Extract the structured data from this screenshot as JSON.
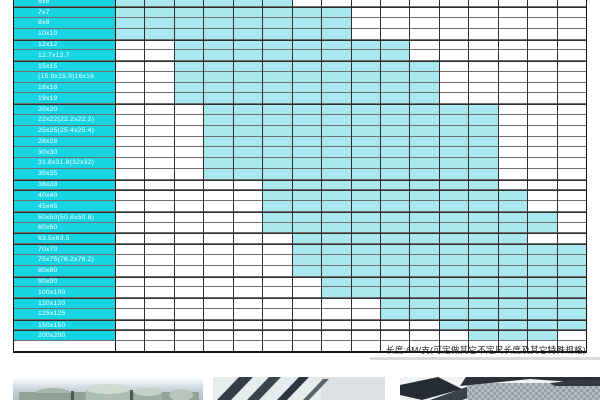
{
  "table": {
    "columns_visible": 16,
    "rows": [
      {
        "label": "6x6",
        "from": 1,
        "to": 6
      },
      {
        "label": "7x7",
        "from": 1,
        "to": 8
      },
      {
        "label": "8x8",
        "from": 1,
        "to": 8
      },
      {
        "label": "10x10",
        "from": 1,
        "to": 8
      },
      {
        "label": "12x12",
        "from": 3,
        "to": 10
      },
      {
        "label": "12.7x12.7",
        "from": 3,
        "to": 10
      },
      {
        "label": "15x15",
        "from": 3,
        "to": 11
      },
      {
        "label": "(15.9x15.9)16x16",
        "from": 3,
        "to": 11
      },
      {
        "label": "18x18",
        "from": 3,
        "to": 11
      },
      {
        "label": "19x19",
        "from": 3,
        "to": 11
      },
      {
        "label": "20x20",
        "from": 4,
        "to": 13
      },
      {
        "label": "22x22(22.2x22.2)",
        "from": 4,
        "to": 13
      },
      {
        "label": "25x25(25.4x25.4)",
        "from": 4,
        "to": 13
      },
      {
        "label": "28x28",
        "from": 4,
        "to": 13
      },
      {
        "label": "30x30",
        "from": 4,
        "to": 13
      },
      {
        "label": "31.8x31.8(32x32)",
        "from": 4,
        "to": 13
      },
      {
        "label": "35x35",
        "from": 4,
        "to": 13
      },
      {
        "label": "38x38",
        "from": 6,
        "to": 13
      },
      {
        "label": "40x40",
        "from": 6,
        "to": 14
      },
      {
        "label": "45x45",
        "from": 6,
        "to": 14
      },
      {
        "label": "50x50(50.8x50.8)",
        "from": 6,
        "to": 15
      },
      {
        "label": "60x60",
        "from": 6,
        "to": 15
      },
      {
        "label": "63.5x63.5",
        "from": 7,
        "to": 14
      },
      {
        "label": "70x70",
        "from": 7,
        "to": 16
      },
      {
        "label": "75x75(76.2x76.2)",
        "from": 7,
        "to": 16
      },
      {
        "label": "80x80",
        "from": 7,
        "to": 16
      },
      {
        "label": "90x90",
        "from": 8,
        "to": 16
      },
      {
        "label": "100x100",
        "from": 8,
        "to": 16
      },
      {
        "label": "120x120",
        "from": 10,
        "to": 16
      },
      {
        "label": "125x125",
        "from": 10,
        "to": 16
      },
      {
        "label": "150x150",
        "from": 12,
        "to": 16
      },
      {
        "label": "200x200",
        "from": 13,
        "to": 15
      }
    ],
    "colors": {
      "label_bg": "#15d4e4",
      "available_cell": "#a9e8ef",
      "empty_cell": "#ffffff",
      "grid_line": "#2d2d2d",
      "row_line": "#6e6e6e"
    }
  },
  "note": {
    "text": "长度:6M/支(可定做其它不定尺长度及其它特殊规格)"
  },
  "photos": [
    {
      "name": "round-steel-billets-photo"
    },
    {
      "name": "slanted-flat-bars-photo"
    },
    {
      "name": "square-tube-profiles-photo"
    }
  ]
}
